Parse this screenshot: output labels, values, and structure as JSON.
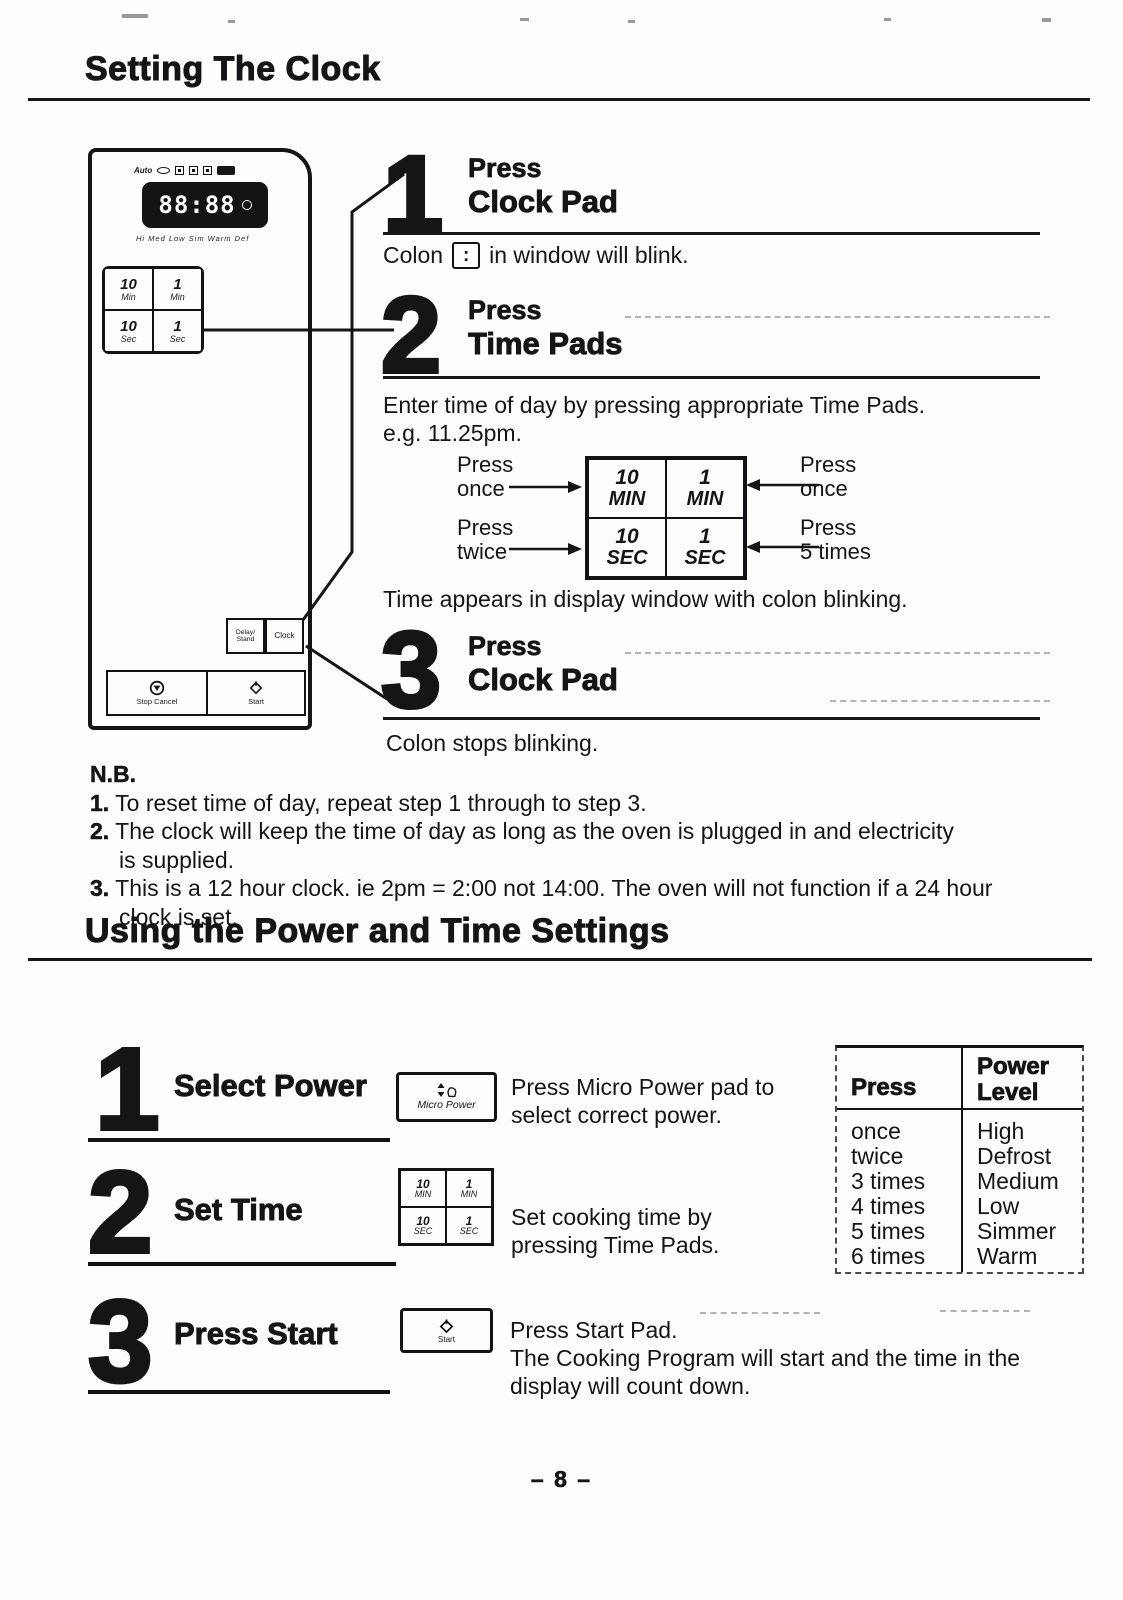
{
  "page": {
    "number": "– 8 –"
  },
  "clock_section": {
    "title": "Setting The Clock",
    "panel": {
      "display_digits": "88:88",
      "indicator_top": "Auto",
      "indicator_bottom": "Hi Med Low Sim Warm Def",
      "pads": {
        "ten_min_num": "10",
        "ten_min_unit": "Min",
        "one_min_num": "1",
        "one_min_unit": "Min",
        "ten_sec_num": "10",
        "ten_sec_unit": "Sec",
        "one_sec_num": "1",
        "one_sec_unit": "Sec"
      },
      "delay_stand_line1": "Delay/",
      "delay_stand_line2": "Stand",
      "clock_pad": "Clock",
      "stop_cancel": "Stop Cancel",
      "start": "Start"
    },
    "step1": {
      "num": "1",
      "action": "Press",
      "target": "Clock Pad",
      "note_pre": "Colon",
      "colon": ":",
      "note_post": "in window will blink."
    },
    "step2": {
      "num": "2",
      "action": "Press",
      "target": "Time Pads",
      "body_line1": "Enter time of day by pressing appropriate Time Pads.",
      "body_line2": "e.g. 11.25pm.",
      "note": "Time appears in display window with colon blinking."
    },
    "pad_diagram": {
      "cells": [
        {
          "num": "10",
          "unit": "MIN"
        },
        {
          "num": "1",
          "unit": "MIN"
        },
        {
          "num": "10",
          "unit": "SEC"
        },
        {
          "num": "1",
          "unit": "SEC"
        }
      ],
      "labels": {
        "tl1": "Press",
        "tl2": "once",
        "bl1": "Press",
        "bl2": "twice",
        "tr1": "Press",
        "tr2": "once",
        "br1": "Press",
        "br2": "5 times"
      }
    },
    "step3": {
      "num": "3",
      "action": "Press",
      "target": "Clock Pad",
      "note": "Colon stops blinking."
    },
    "nb": {
      "title": "N.B.",
      "item1_num": "1.",
      "item1": "To reset time of day, repeat step 1 through to step 3.",
      "item2_num": "2.",
      "item2a": "The clock will keep the time of day as long as the oven is plugged in and electricity",
      "item2b": "is supplied.",
      "item3_num": "3.",
      "item3a": "This is a 12 hour clock. ie 2pm = 2:00 not 14:00. The oven will not function if a 24 hour",
      "item3b": "clock is set."
    }
  },
  "power_section": {
    "title": "Using the Power and Time Settings",
    "step1": {
      "num": "1",
      "label": "Select Power",
      "pad": "Micro Power",
      "desc1": "Press Micro Power pad to",
      "desc2": "select correct power."
    },
    "step2": {
      "num": "2",
      "label": "Set Time",
      "desc1": "Set cooking time by",
      "desc2": "pressing Time Pads."
    },
    "step3": {
      "num": "3",
      "label": "Press Start",
      "pad": "Start",
      "desc1": "Press Start Pad.",
      "desc2": "The Cooking Program will start and the time in the",
      "desc3": "display will count down."
    },
    "mini_pads": {
      "c1num": "10",
      "c1unit": "MIN",
      "c2num": "1",
      "c2unit": "MIN",
      "c3num": "10",
      "c3unit": "SEC",
      "c4num": "1",
      "c4unit": "SEC"
    },
    "table": {
      "header1": "Press",
      "header2a": "Power",
      "header2b": "Level",
      "rows": [
        [
          "once",
          "High"
        ],
        [
          "twice",
          "Defrost"
        ],
        [
          "3 times",
          "Medium"
        ],
        [
          "4 times",
          "Low"
        ],
        [
          "5 times",
          "Simmer"
        ],
        [
          "6 times",
          "Warm"
        ]
      ]
    }
  }
}
